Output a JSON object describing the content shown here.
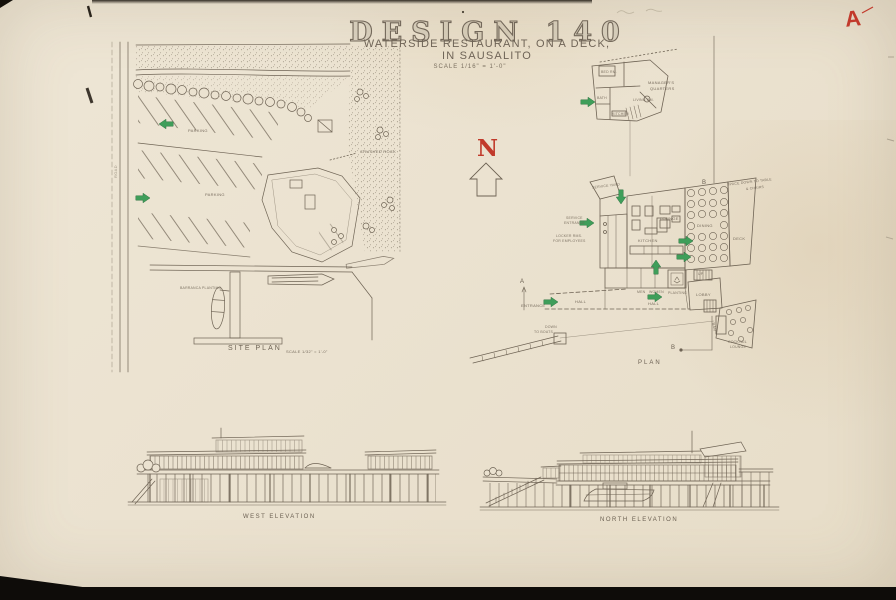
{
  "colors": {
    "paper": "#ebe2d0",
    "ink": "#6e6354",
    "accent_red": "#c23a2c",
    "accent_green": "#3f9e5a"
  },
  "title_block": {
    "course_title": "DESIGN 140",
    "subtitle1": "WATERSIDE RESTAURANT, ON A DECK,",
    "subtitle2": "IN SAUSALITO",
    "scale": "SCALE  1/16\" = 1'-0\"",
    "grade": "A"
  },
  "north_arrow": {
    "letter": "N"
  },
  "site_plan": {
    "caption": "SITE PLAN",
    "caption_scale": "SCALE 1/32\" = 1'-0\"",
    "road": "ROAD",
    "parking1": "PARKING",
    "parking2": "PARKING",
    "crushed_rock": "CRUSHED ROCK",
    "barranca": "BARRANCA PLANTING"
  },
  "quarters": {
    "caption1": "MANAGER'S",
    "caption2": "QUARTERS",
    "bed": "BED RM.",
    "bath": "BATH",
    "living": "LIVING RM.",
    "kitchen": "KITCHEN"
  },
  "plan": {
    "caption": "PLAN",
    "deck_note1": "SPACE DOWN TO TABLE",
    "deck_note2": "& CHAIRS",
    "kitchen": "KITCHEN",
    "lounge": "LOUNGE",
    "dining": "DINING",
    "deck": "DECK",
    "bar": "BAR",
    "lobby": "LOBBY",
    "up": "UP",
    "men": "MEN",
    "women": "WOMEN",
    "planting": "PLANTING",
    "hall": "HALL",
    "entrance": "ENTRANCE",
    "down": "DOWN",
    "to_boats": "TO BOATS",
    "service_yard": "SERVICE YARD",
    "service1": "SERVICE",
    "service2": "ENTRANCE",
    "lockers1": "LOCKER RMS.",
    "lockers2": "FOR EMPLOYEES",
    "cocktail1": "COCKTAIL",
    "cocktail2": "LOUNGE",
    "sec_a": "A",
    "sec_b": "B"
  },
  "elevations": {
    "west_caption": "WEST ELEVATION",
    "north_caption": "NORTH ELEVATION"
  }
}
